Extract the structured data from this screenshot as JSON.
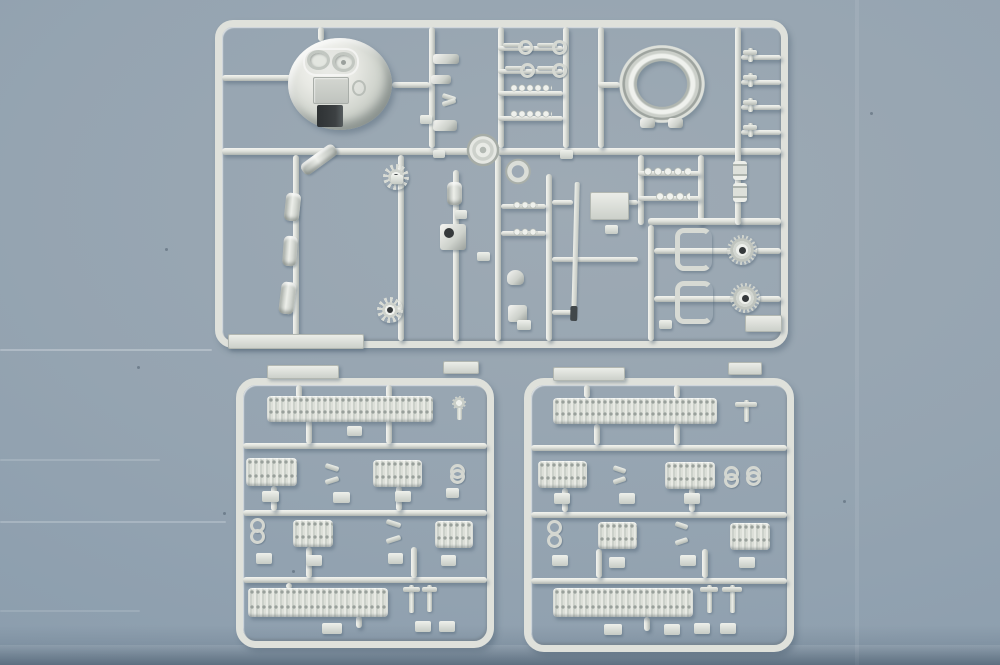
{
  "image_type": "photograph",
  "subject": "Three silver-grey injection-moulded plastic model-kit sprues (runner frames full of tank parts) photographed top-down on a brushed blue-grey metal surface",
  "visible_text": "none",
  "background": {
    "surface": "blue-grey painted metal sheet",
    "features": [
      "soft top-left lighting",
      "faint horizontal brush streaks at lower left",
      "tiny dark specks",
      "darker shadow band along the bottom edge"
    ]
  },
  "palette": {
    "bg_a": "#9eaab4",
    "bg_b": "#95a4b1",
    "bg_c": "#8c9eae",
    "bg_d": "#8295a7",
    "plastic": "#dfe1db",
    "plastic_hi": "#f3f4f0",
    "plastic_sh": "#aeb4b0",
    "metal": "#cdd1cb",
    "metal_hi": "#f5f5f2",
    "metal_dark": "#9aa09c",
    "hole": "#35393b",
    "shadow": "rgba(74,96,112,0.40)"
  },
  "sprues": [
    {
      "id": "main-parts-sprue",
      "location": "top, spanning most of the image width",
      "shape": "large rounded-corner rectangular runner frame with internal lattice of runners",
      "notable_parts": [
        {
          "name": "turret-dome",
          "count": 1,
          "position": "upper left",
          "desc": "domed turret roof with two round hatches on a raised plateau, a small centre panel and a dark rectangular gun opening at its lower edge"
        },
        {
          "name": "turret-ring",
          "count": 1,
          "position": "upper right",
          "desc": "large open ring with two mounting tabs at its base"
        },
        {
          "name": "eyelet-rods",
          "count": 4,
          "position": "upper centre ladder"
        },
        {
          "name": "bead-link-rods",
          "count": 2,
          "position": "upper centre ladder"
        },
        {
          "name": "small-hook-fittings",
          "count": 8,
          "position": "columns beside dome and along right edge"
        },
        {
          "name": "idler-gear-wheels",
          "count": 2,
          "desc": "12-tooth star wheels with dark centre holes",
          "position": "mid band left"
        },
        {
          "name": "axle-pins",
          "count": 3,
          "position": "left inner runner"
        },
        {
          "name": "angled-cylinder",
          "count": 1,
          "position": "mid band left"
        },
        {
          "name": "road-wheel-disc",
          "count": 1,
          "position": "centre on main runner"
        },
        {
          "name": "clamp-ring",
          "count": 1,
          "position": "centre"
        },
        {
          "name": "mantlet-block-with-bore",
          "count": 1,
          "position": "centre"
        },
        {
          "name": "gun-barrel",
          "count": 1,
          "desc": "long thin tapered barrel with dark muzzle tip",
          "position": "centre, vertical"
        },
        {
          "name": "torsion-bar-rods",
          "count": 2,
          "position": "right of centre"
        },
        {
          "name": "spool-fittings",
          "count": 2,
          "position": "right runner"
        },
        {
          "name": "c-brackets",
          "count": 2,
          "position": "lower right sub-frame"
        },
        {
          "name": "drive-sprockets",
          "count": 2,
          "desc": "toothed wheels with dark hub holes",
          "position": "lower right sub-frame"
        },
        {
          "name": "mounting-plates",
          "count": 3,
          "position": "bottom-left edge, mid right, bottom-right corner"
        },
        {
          "name": "sprue-gate-tabs",
          "count": "many",
          "position": "scattered"
        }
      ]
    },
    {
      "id": "track-sprue-left",
      "location": "bottom left",
      "shape": "square rounded runner frame with three internal cross runners and two flat tabs above its top edge",
      "notable_parts": [
        {
          "name": "long-track-run",
          "count": 2,
          "position": "top row and bottom row"
        },
        {
          "name": "short-track-run",
          "count": 4,
          "position": "two middle rows"
        },
        {
          "name": "track-end-links",
          "count": 6,
          "position": "between track runs"
        },
        {
          "name": "sprue-gate-tabs",
          "count": "about 12",
          "position": "below each part"
        }
      ]
    },
    {
      "id": "track-sprue-right",
      "location": "bottom right",
      "shape": "square rounded runner frame with three internal cross runners and two flat tabs above its top edge",
      "notable_parts": [
        {
          "name": "long-track-run",
          "count": 2,
          "position": "top row and bottom row"
        },
        {
          "name": "short-track-run",
          "count": 4,
          "position": "two middle rows"
        },
        {
          "name": "track-end-links",
          "count": 7,
          "position": "between track runs"
        },
        {
          "name": "sprue-gate-tabs",
          "count": "about 12",
          "position": "below each part"
        }
      ]
    }
  ]
}
